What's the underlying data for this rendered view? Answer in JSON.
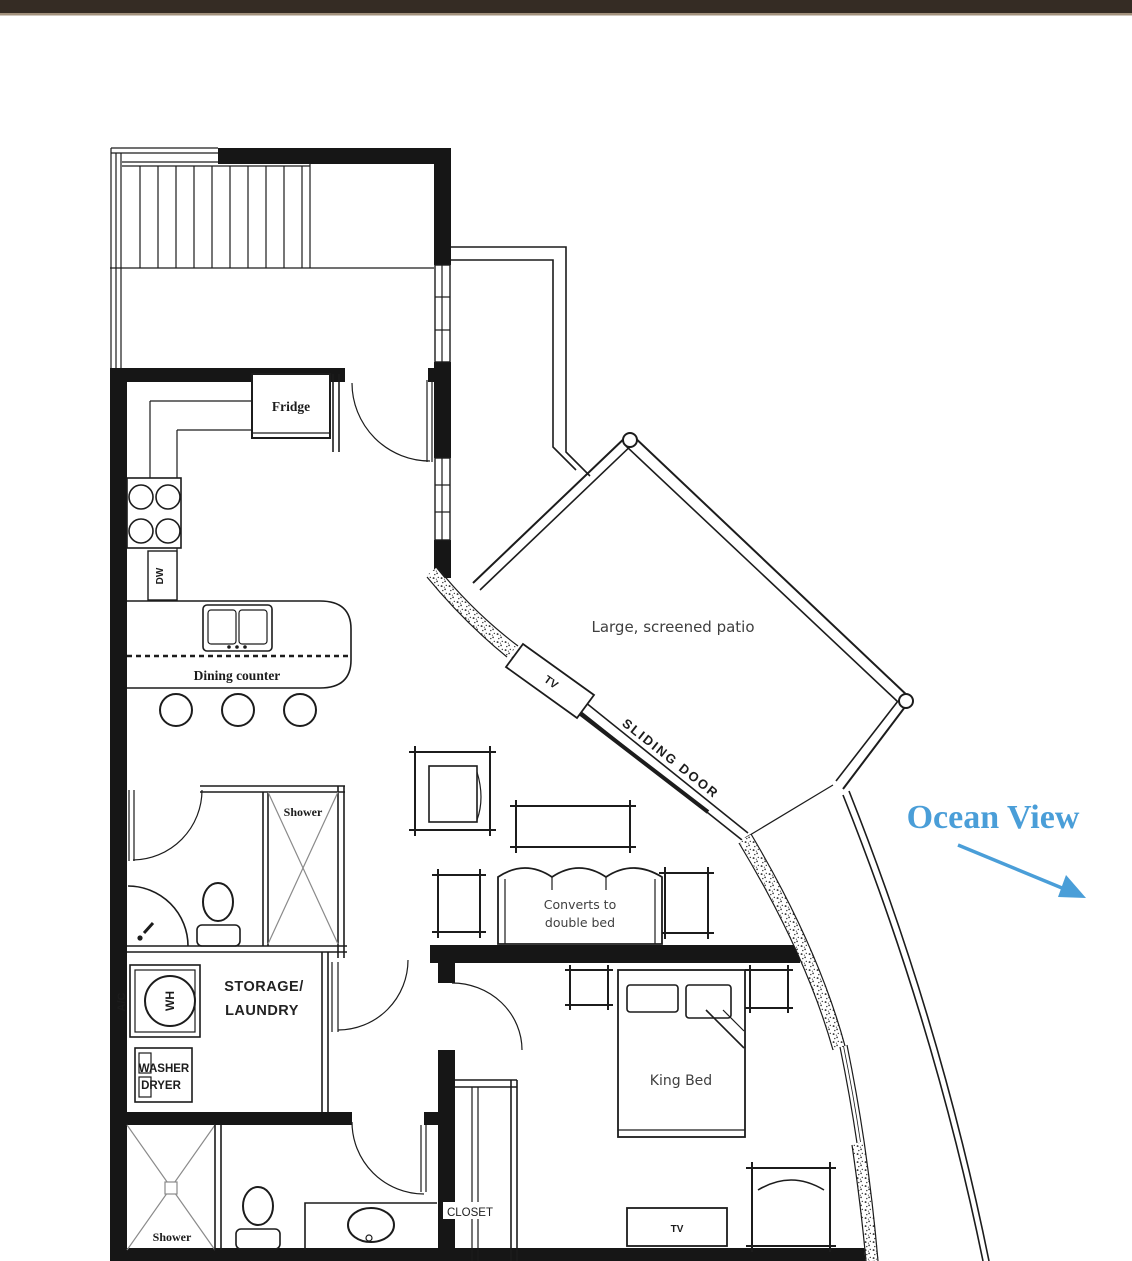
{
  "page": {
    "top_bar_color": "#352c24",
    "top_bar_accent": "#a2917c",
    "background": "#ffffff"
  },
  "colors": {
    "ink": "#1c1c1c",
    "soft_ink": "#3f3f3f",
    "accent_blue": "#4a9ed8"
  },
  "labels": {
    "fridge": "Fridge",
    "dw": "DW",
    "dining_counter": "Dining counter",
    "patio": "Large, screened patio",
    "patio_tv": "TV",
    "sliding_door": "SLIDING  DOOR",
    "ocean_view": "Ocean View",
    "shower_main": "Shower",
    "sofa_line1": "Converts to",
    "sofa_line2": "double bed",
    "storage_line1": "STORAGE/",
    "storage_line2": "LAUNDRY",
    "ac": "A/C",
    "wh": "WH",
    "washer_line1": "WASHER",
    "washer_line2": "DRYER",
    "king_bed": "King Bed",
    "closet": "CLOSET",
    "bedroom_tv": "TV",
    "shower_guest": "Shower"
  }
}
